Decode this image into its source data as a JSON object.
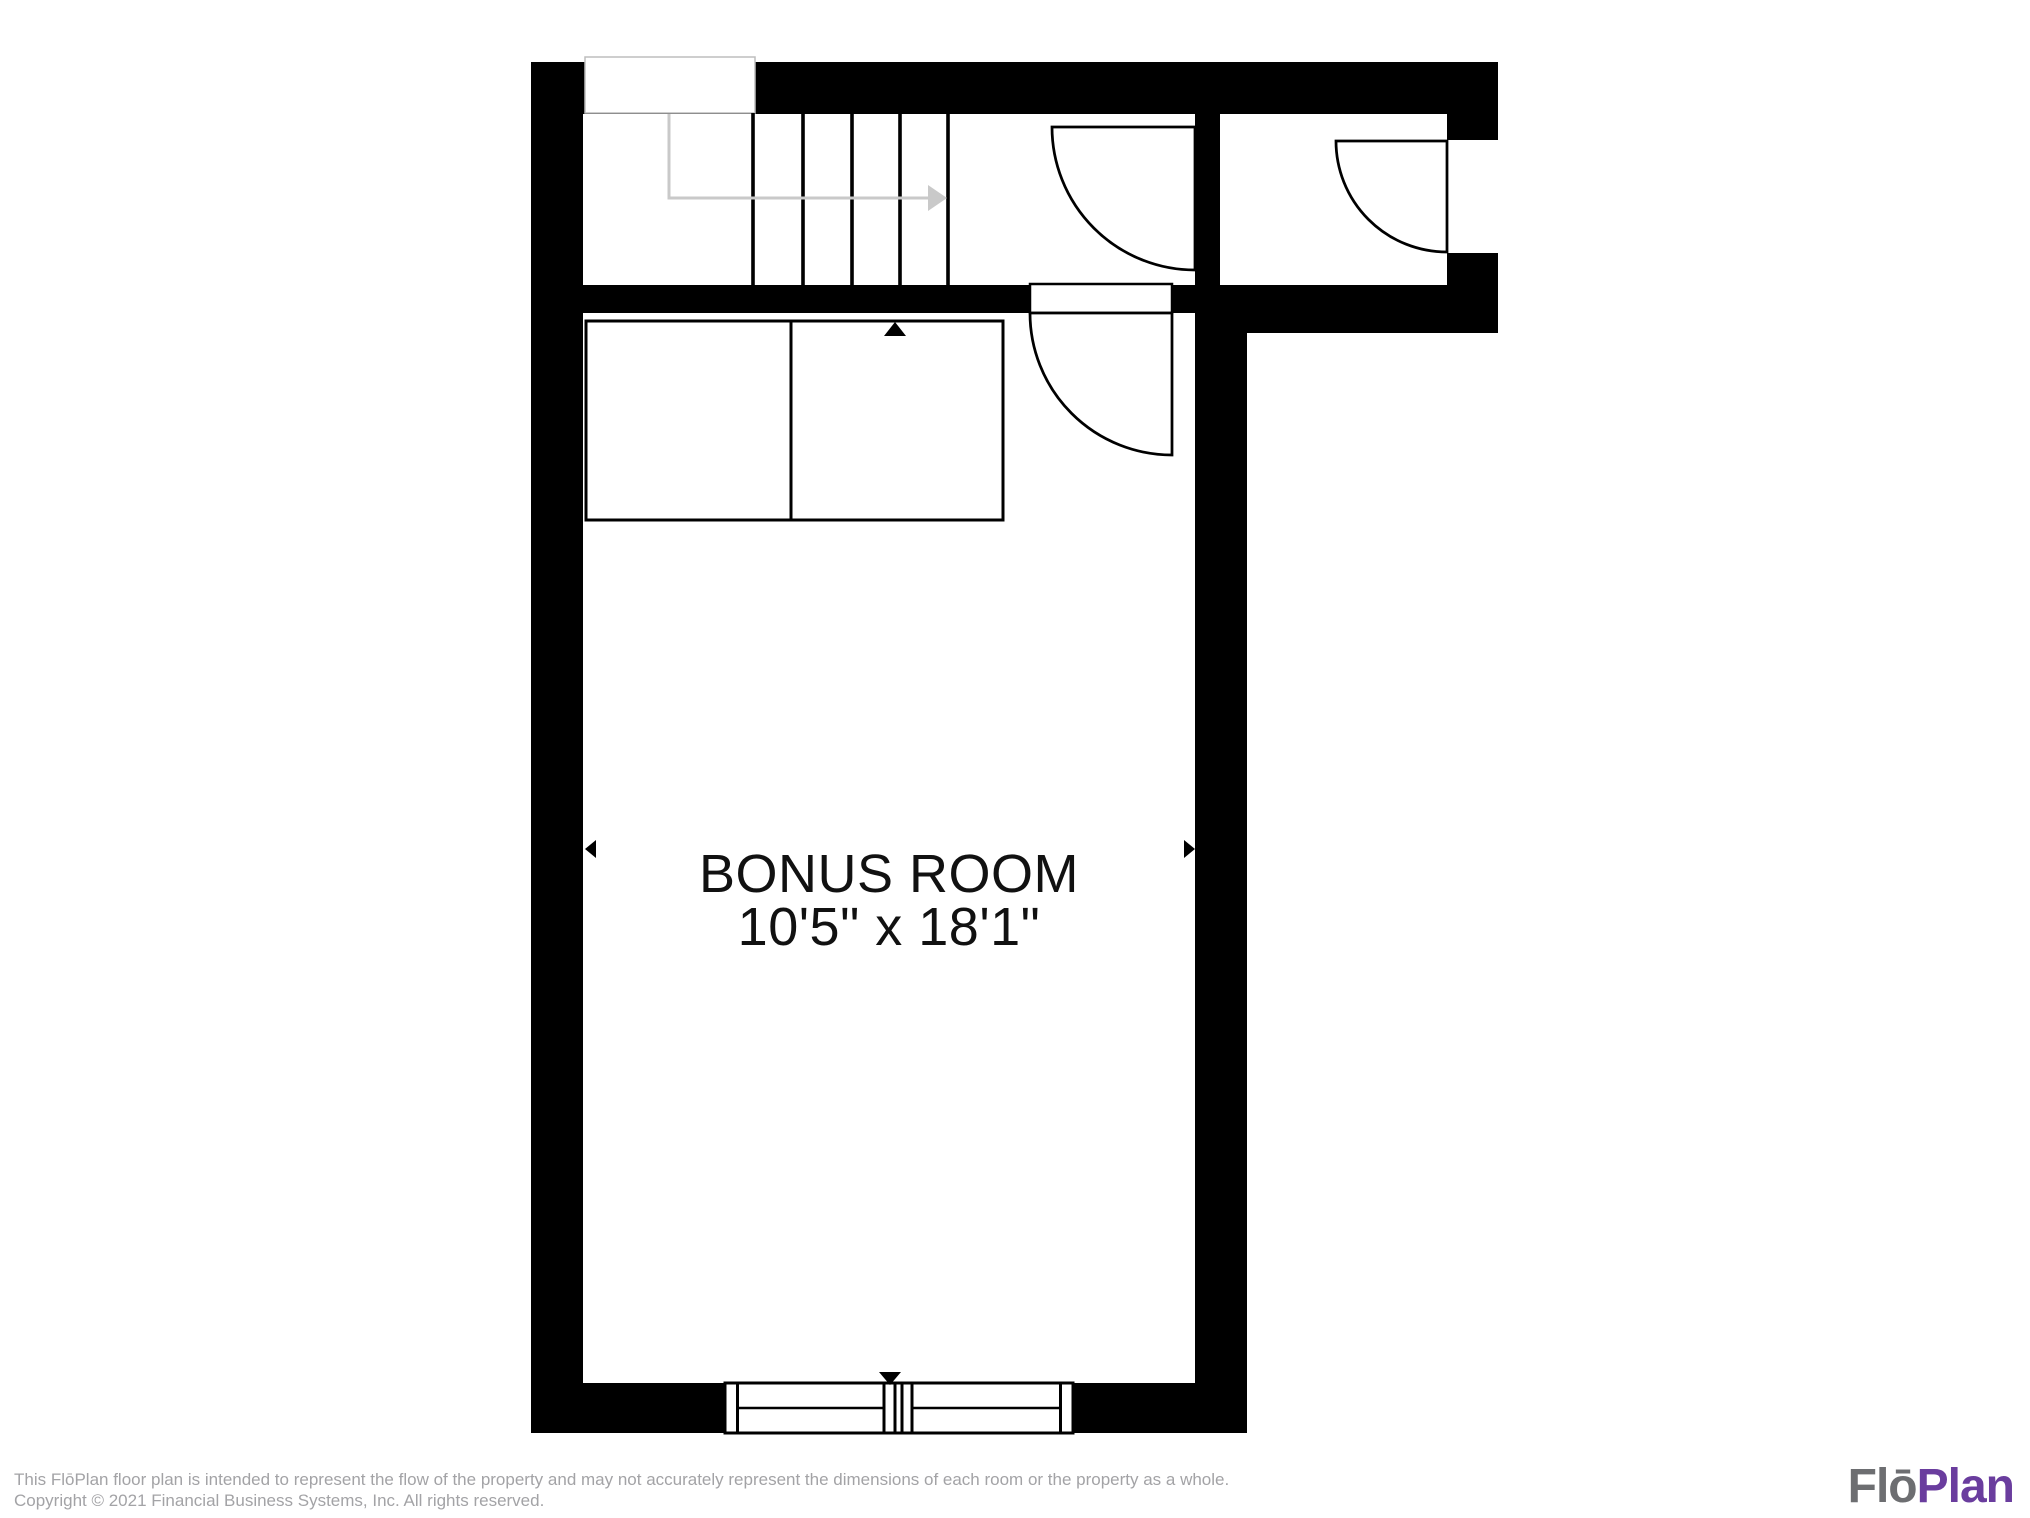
{
  "document": {
    "type": "floor-plan"
  },
  "room": {
    "label": "BONUS ROOM",
    "dimensions": "10'5\" x 18'1\""
  },
  "footer": {
    "disclaimer": "This FlōPlan floor plan is intended to represent the flow of the property and may not accurately represent the dimensions of each room or the property as a whole.",
    "copyright": "Copyright © 2021 Financial Business Systems, Inc. All rights reserved."
  },
  "logo": {
    "gray_part": "Flō",
    "purple_part": "Plan"
  },
  "icons": {
    "stair_direction": "stair-direction-arrow",
    "dimension_markers": [
      "arrow-up",
      "arrow-down",
      "arrow-left",
      "arrow-right"
    ]
  },
  "colors": {
    "wall": "#000000",
    "door_outline": "#000000",
    "stair_arrow": "#c9c9c9",
    "notch_outline": "#bdbdbd",
    "room_text": "#111111",
    "footer_text": "#a3a3a6",
    "logo_gray": "#6d6e71",
    "logo_purple": "#6a3d9e"
  }
}
